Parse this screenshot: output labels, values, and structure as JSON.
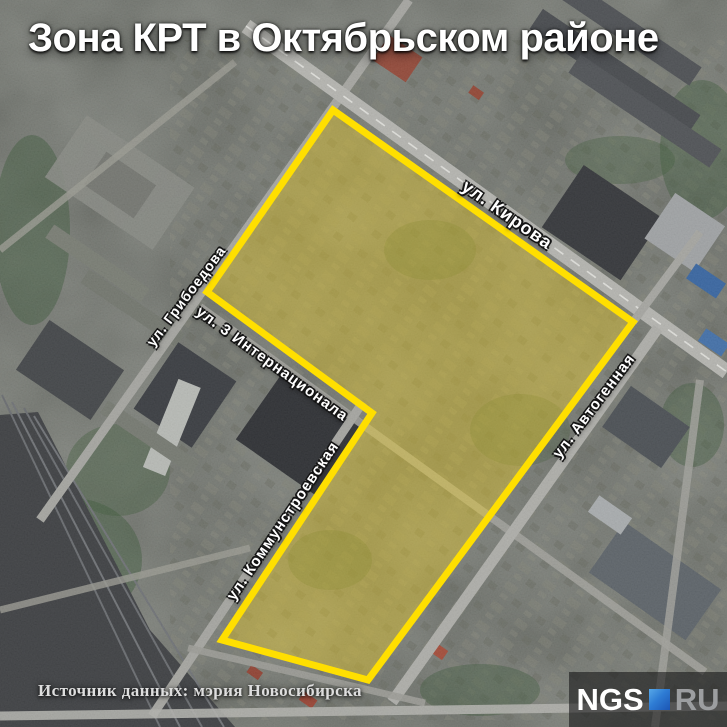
{
  "title": "Зона КРТ в Октябрьском районе",
  "map": {
    "zone": {
      "label": "Зона КРТ",
      "points": "333,110 633,322 368,680 222,640 372,413 207,292",
      "outline_color": "#ffdf00",
      "fill_color": "rgba(253,216,24,0.36)"
    },
    "street_labels": [
      {
        "label": "ул. Кирова"
      },
      {
        "label": "ул. Грибоедова"
      },
      {
        "label": "ул. 3 Интернационала"
      },
      {
        "label": "ул. Коммунстроевская"
      },
      {
        "label": "ул. Автогенная"
      }
    ]
  },
  "footer": {
    "source": "Источник данных: мэрия Новосибирска"
  },
  "logo": {
    "ngs": "NGS",
    "ru": "RU",
    "accent_color": "#2e7cd4"
  }
}
